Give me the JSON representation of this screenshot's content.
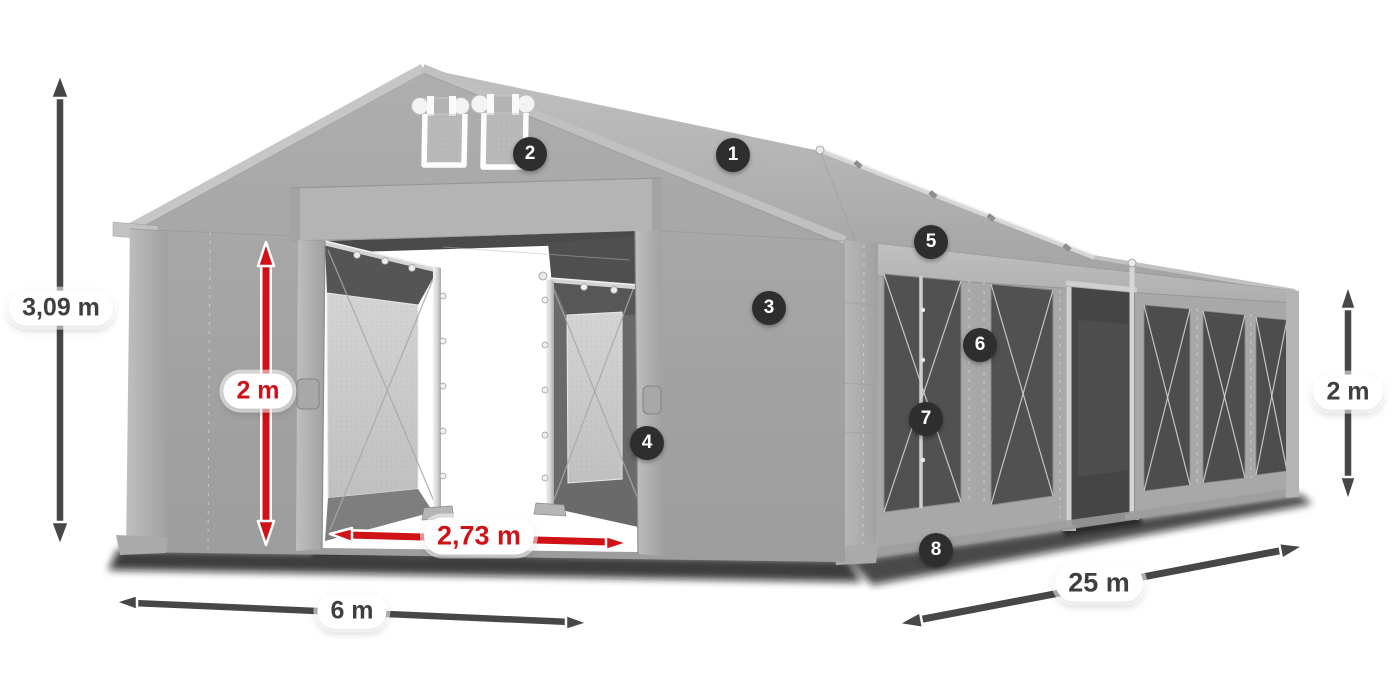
{
  "diagram": {
    "subject": "tent-structure-with-dimensions"
  },
  "dimensions": {
    "total_height": {
      "label": "3,09 m",
      "style": "dark"
    },
    "door_height": {
      "label": "2 m",
      "style": "red"
    },
    "door_width": {
      "label": "2,73 m",
      "style": "red"
    },
    "front_width": {
      "label": "6 m",
      "style": "dark"
    },
    "side_length": {
      "label": "25 m",
      "style": "dark"
    },
    "side_height": {
      "label": "2 m",
      "style": "dark"
    }
  },
  "callouts": [
    {
      "number": "1"
    },
    {
      "number": "2"
    },
    {
      "number": "3"
    },
    {
      "number": "4"
    },
    {
      "number": "5"
    },
    {
      "number": "6"
    },
    {
      "number": "7"
    },
    {
      "number": "8"
    }
  ],
  "colors": {
    "accent_red": "#d01217",
    "arrow_dark": "#474747",
    "callout_bg": "#2e2e2e",
    "label_text": "#3f3f3f"
  }
}
